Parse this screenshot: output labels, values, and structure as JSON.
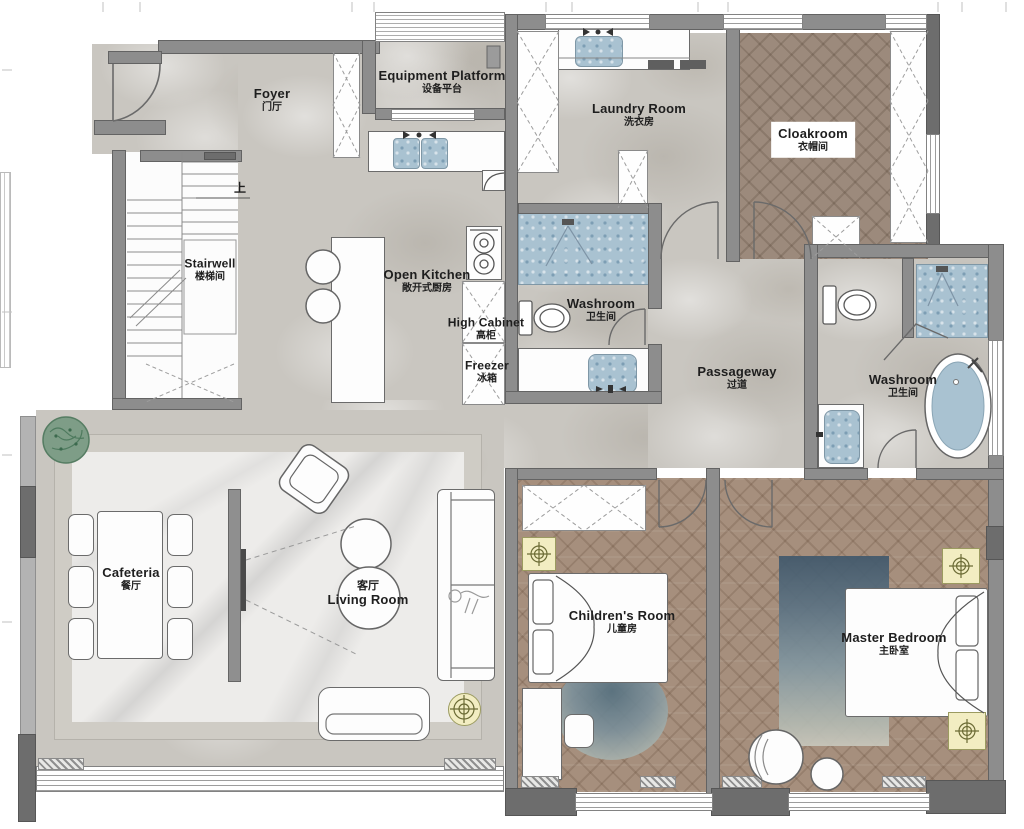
{
  "plan_title": "Apartment floor plan (first floor)",
  "rooms": [
    {
      "id": "foyer",
      "en": "Foyer",
      "zh": "门厅"
    },
    {
      "id": "equipment-platform",
      "en": "Equipment Platform",
      "zh": "设备平台"
    },
    {
      "id": "laundry-room",
      "en": "Laundry Room",
      "zh": "洗衣房"
    },
    {
      "id": "cloakroom",
      "en": "Cloakroom",
      "zh": "衣帽间"
    },
    {
      "id": "stairwell",
      "en": "Stairwell",
      "zh": "楼梯间"
    },
    {
      "id": "open-kitchen",
      "en": "Open Kitchen",
      "zh": "敞开式厨房"
    },
    {
      "id": "high-cabinet",
      "en": "High Cabinet",
      "zh": "高柜"
    },
    {
      "id": "freezer",
      "en": "Freezer",
      "zh": "冰箱"
    },
    {
      "id": "washroom-middle",
      "en": "Washroom",
      "zh": "卫生间"
    },
    {
      "id": "passageway",
      "en": "Passageway",
      "zh": "过道"
    },
    {
      "id": "washroom-ensuite",
      "en": "Washroom",
      "zh": "卫生间"
    },
    {
      "id": "cafeteria",
      "en": "Cafeteria",
      "zh": "餐厅"
    },
    {
      "id": "living-room",
      "en": "Living Room",
      "zh": "客厅"
    },
    {
      "id": "childrens-room",
      "en": "Children's Room",
      "zh": "儿童房"
    },
    {
      "id": "master-bedroom",
      "en": "Master Bedroom",
      "zh": "主卧室"
    }
  ],
  "annotations": {
    "stairs_up": "上"
  },
  "colors": {
    "wall": "#8d8d8d",
    "wall_dark": "#6d6d6d",
    "stone_floor": "#c9c6c0",
    "marble_floor": "#edecea",
    "wood_floor": "#a68f7d",
    "tile_blue": "#a9c2d1",
    "rug_blue": "#5d7383",
    "lamp_yellow": "#f2edc2",
    "plant_green": "#7e9d87",
    "rug_frame": "#cfccc5"
  }
}
